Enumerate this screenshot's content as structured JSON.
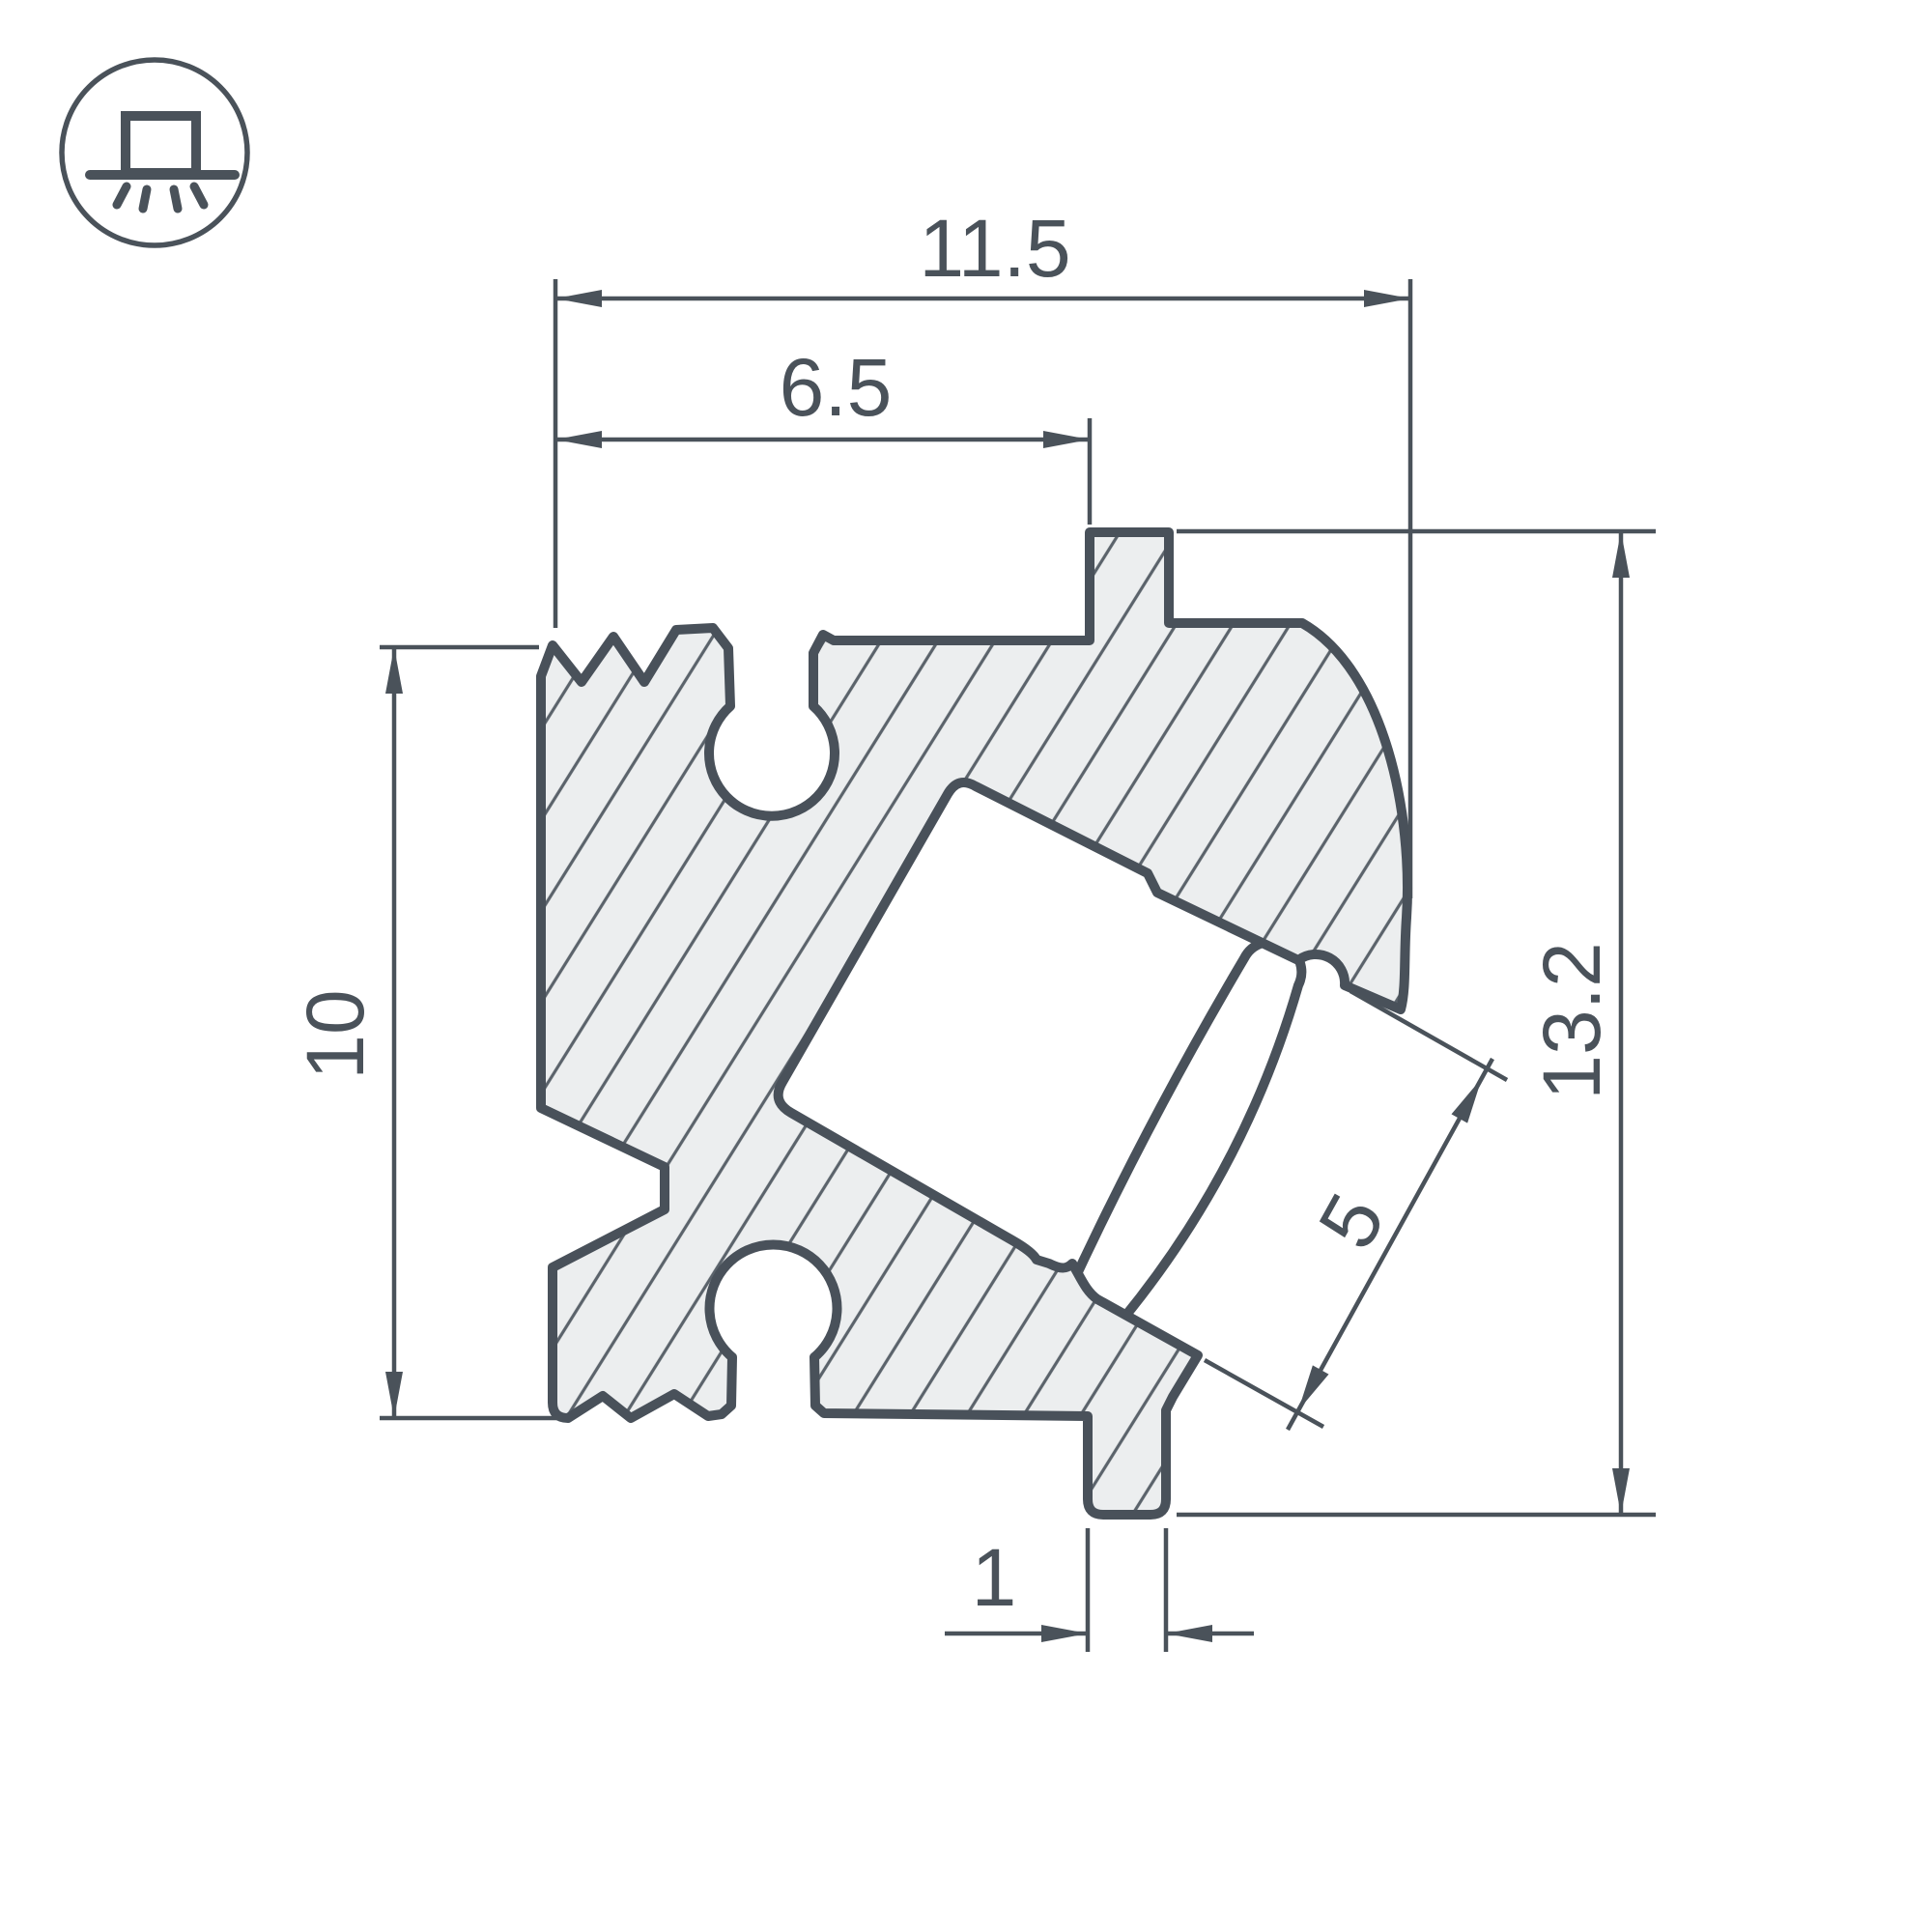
{
  "drawing": {
    "type": "profile-cross-section",
    "dimensions": {
      "overall_width": "11.5",
      "inner_width": "6.5",
      "left_height": "10",
      "overall_height": "13.2",
      "slot_width": "5",
      "foot_width": "1"
    },
    "icon": {
      "meaning": "surface-mounted-luminaire-symbol"
    },
    "colors": {
      "line": "#4a525a",
      "body_fill": "#eceeef",
      "hatch_line": "#5b636b",
      "background": "#ffffff"
    }
  }
}
